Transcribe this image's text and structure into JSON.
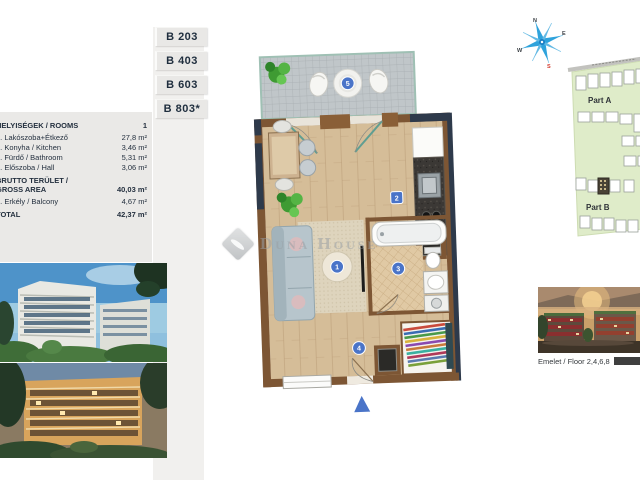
{
  "units": {
    "items": [
      {
        "label": "B 203"
      },
      {
        "label": "B 403"
      },
      {
        "label": "B 603"
      },
      {
        "label": "B 803*"
      }
    ]
  },
  "rooms_table": {
    "header": {
      "label": "HELYISÉGEK / ROOMS",
      "value": "1"
    },
    "rows": [
      {
        "label": "1. Lakószoba+Étkező",
        "value": "27,8 m²"
      },
      {
        "label": "2. Konyha / Kitchen",
        "value": "3,46 m²"
      },
      {
        "label": "3. Fürdő / Bathroom",
        "value": "5,31 m²"
      },
      {
        "label": "4. Előszoba / Hall",
        "value": "3,06 m²"
      }
    ],
    "gross": {
      "label_line1": "BRUTTO TERÜLET /",
      "label_line2": "GROSS AREA",
      "value": "40,03 m²"
    },
    "balcony": {
      "label": "5. Erkély / Balcony",
      "value": "4,67 m²"
    },
    "total": {
      "label": "TOTAL",
      "value": "42,37 m²"
    }
  },
  "floorplan": {
    "markers": [
      "1",
      "2",
      "3",
      "4",
      "5"
    ]
  },
  "watermark": {
    "brand": "Duna House"
  },
  "compass": {
    "north": "N",
    "east": "E",
    "south": "S",
    "west": "W"
  },
  "site_map": {
    "part_a": "Part A",
    "part_b": "Part B"
  },
  "floor_caption": {
    "text": "Emelet / Floor 2,4,6,8"
  },
  "colors": {
    "accent_blue": "#4a74c8",
    "compass_blue": "#2fa3dc",
    "south_red": "#d23b2f",
    "map_green": "#dfecc9"
  }
}
